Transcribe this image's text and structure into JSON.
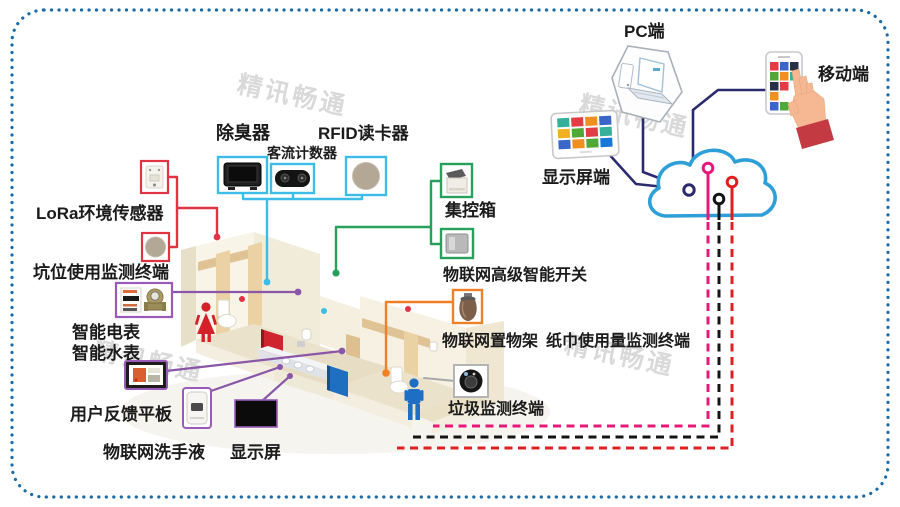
{
  "watermark_text": "精讯畅通",
  "endpoints": {
    "pc_label": "PC端",
    "mobile_label": "移动端",
    "display_terminal_label": "显示屏端"
  },
  "device_labels": {
    "deodorizer": "除臭器",
    "passenger_counter": "客流计数器",
    "rfid_reader": "RFID读卡器",
    "lora_env_sensor": "LoRa环境传感器",
    "pit_usage_monitor": "坑位使用监测终端",
    "smart_electric_meter": "智能电表",
    "smart_water_meter": "智能水表",
    "user_feedback_tablet": "用户反馈平板",
    "iot_hand_sanitizer": "物联网洗手液",
    "display_screen": "显示屏",
    "central_control_box": "集控箱",
    "iot_smart_switch": "物联网高级智能开关",
    "iot_shelf": "物联网置物架",
    "paper_usage_monitor": "纸巾使用量监测终端",
    "garbage_monitor": "垃圾监测终端"
  },
  "colors": {
    "border": "#1a6ba6",
    "cloud": "#2f9fd8",
    "link_navy": "#2b2a6e",
    "link_red": "#e03344",
    "link_cyan": "#3bbde8",
    "link_green": "#27a05c",
    "link_purple": "#8a56a8",
    "link_orange": "#f08026",
    "link_gray": "#a9a9a9",
    "dash_pink": "#e81878",
    "dash_black": "#141414",
    "dash_red": "#e02020",
    "female_figure": "#d42129",
    "male_figure": "#1e6fc4"
  }
}
